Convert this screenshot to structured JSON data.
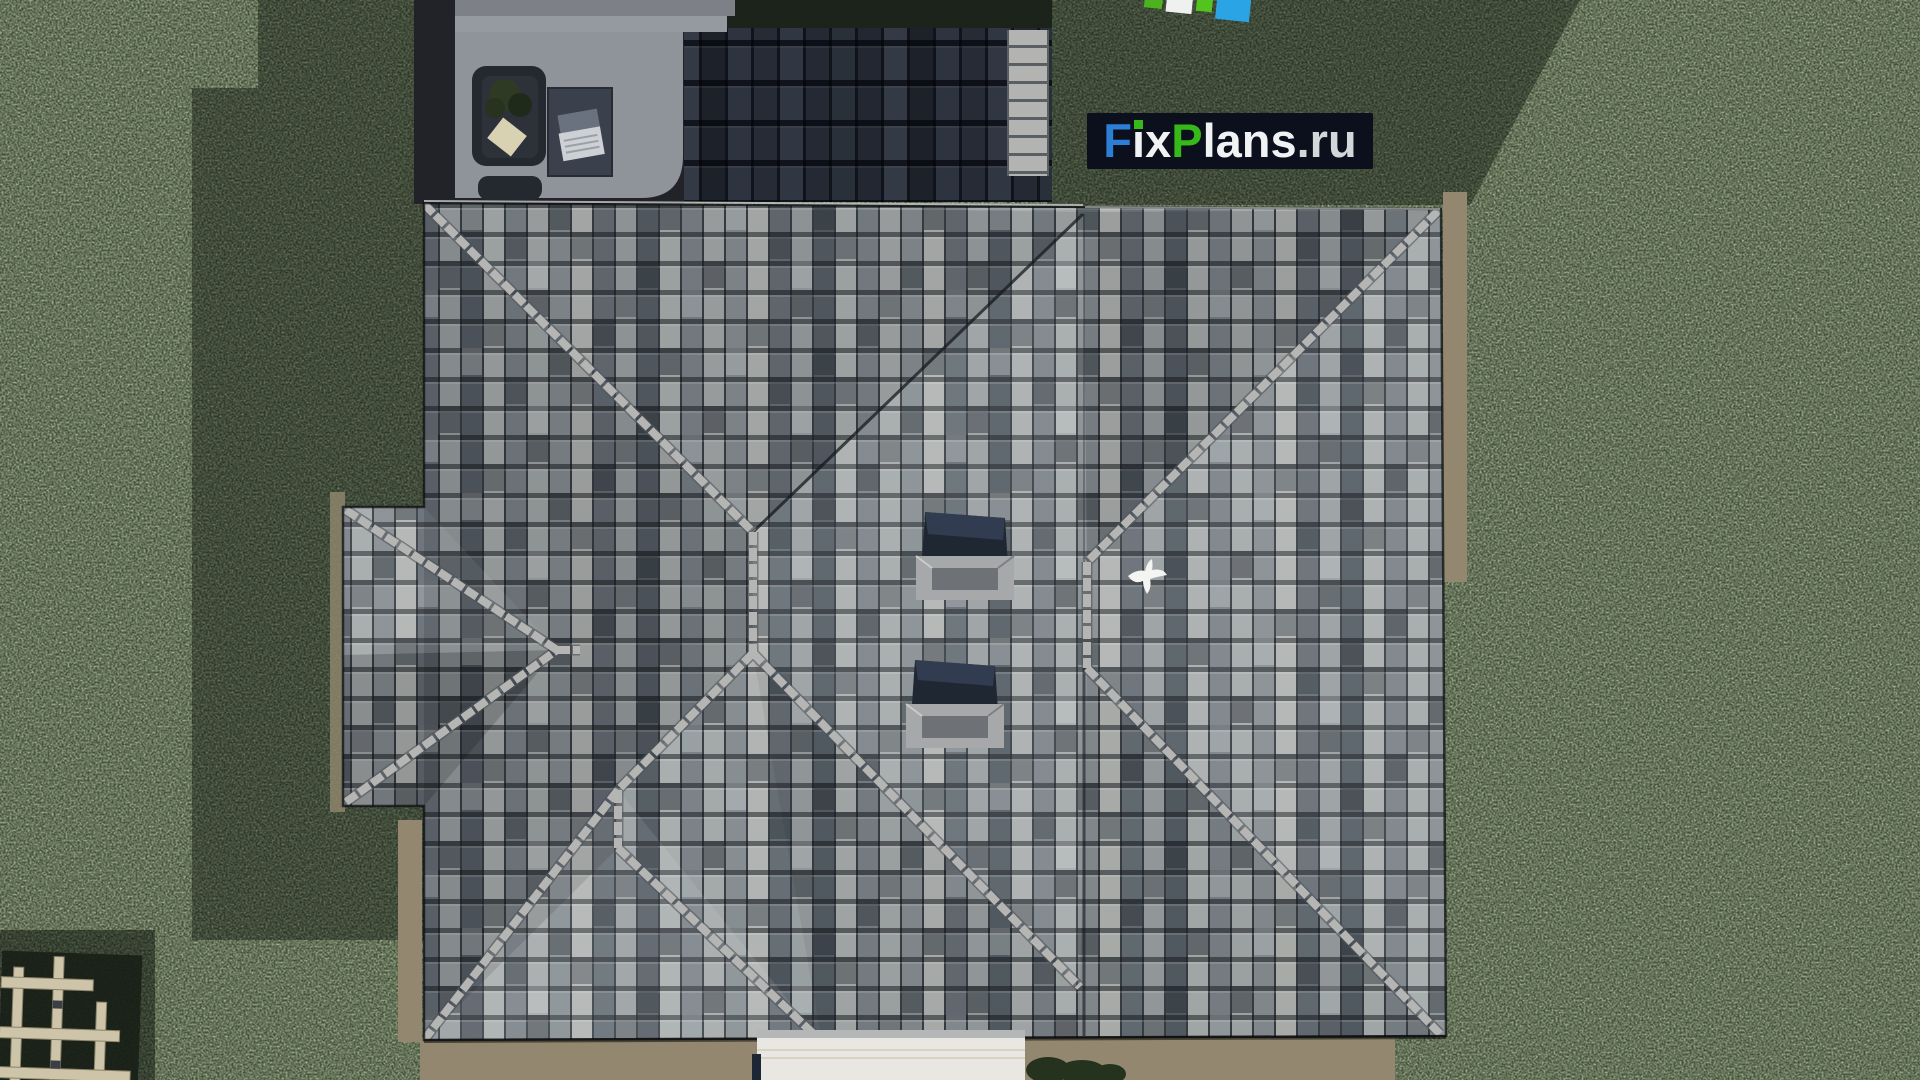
{
  "watermark": {
    "part_f": "F",
    "part_i": "i",
    "part_x": "x",
    "part_p": "P",
    "part_lans": "lans",
    "part_domain": ".ru",
    "bg_color": "#0b101c",
    "f_color": "#2d7fd6",
    "p_color": "#36b71a",
    "text_color": "#f0f2f4",
    "domain_color": "#d4d7da"
  },
  "logo_mark": {
    "colors": [
      "#4cb31e",
      "#eff1f0",
      "#52c41d",
      "#2aa4e4"
    ]
  },
  "palette": {
    "grass_base": "#3f4c35",
    "grass_shadow": "#0c120c",
    "roof_tile_base": "#82878b",
    "roof_tile_light": "#b1b4b2",
    "roof_tile_dark": "#565e66",
    "ridge_cap": "#b5b6b4",
    "dark_roof_tile": "#20252d",
    "terrace_concrete": "#8f939a",
    "gravel": "#93886f",
    "walkway": "#e9e7e2",
    "pergola_wood": "#cdc4a9",
    "skylight_glass": "#1f2733",
    "skylight_frame": "#a6a8aa",
    "bird": "#f4f4f2",
    "sofa": "#24282f",
    "table": "#3a404c",
    "cushion": "#d8d2b2",
    "hedge": "#25321e"
  },
  "scene": {
    "description": "Aerial top-down 3D render of a hip-roofed house with gray tiles on a green lawn",
    "objects": [
      "hip-roof",
      "dark-upper-roof",
      "roof-terrace",
      "outdoor-sofa",
      "coffee-table",
      "laptop",
      "skylight",
      "skylight",
      "flying-bird",
      "wooden-pergola",
      "white-walkway",
      "gravel-border",
      "hedge"
    ]
  }
}
